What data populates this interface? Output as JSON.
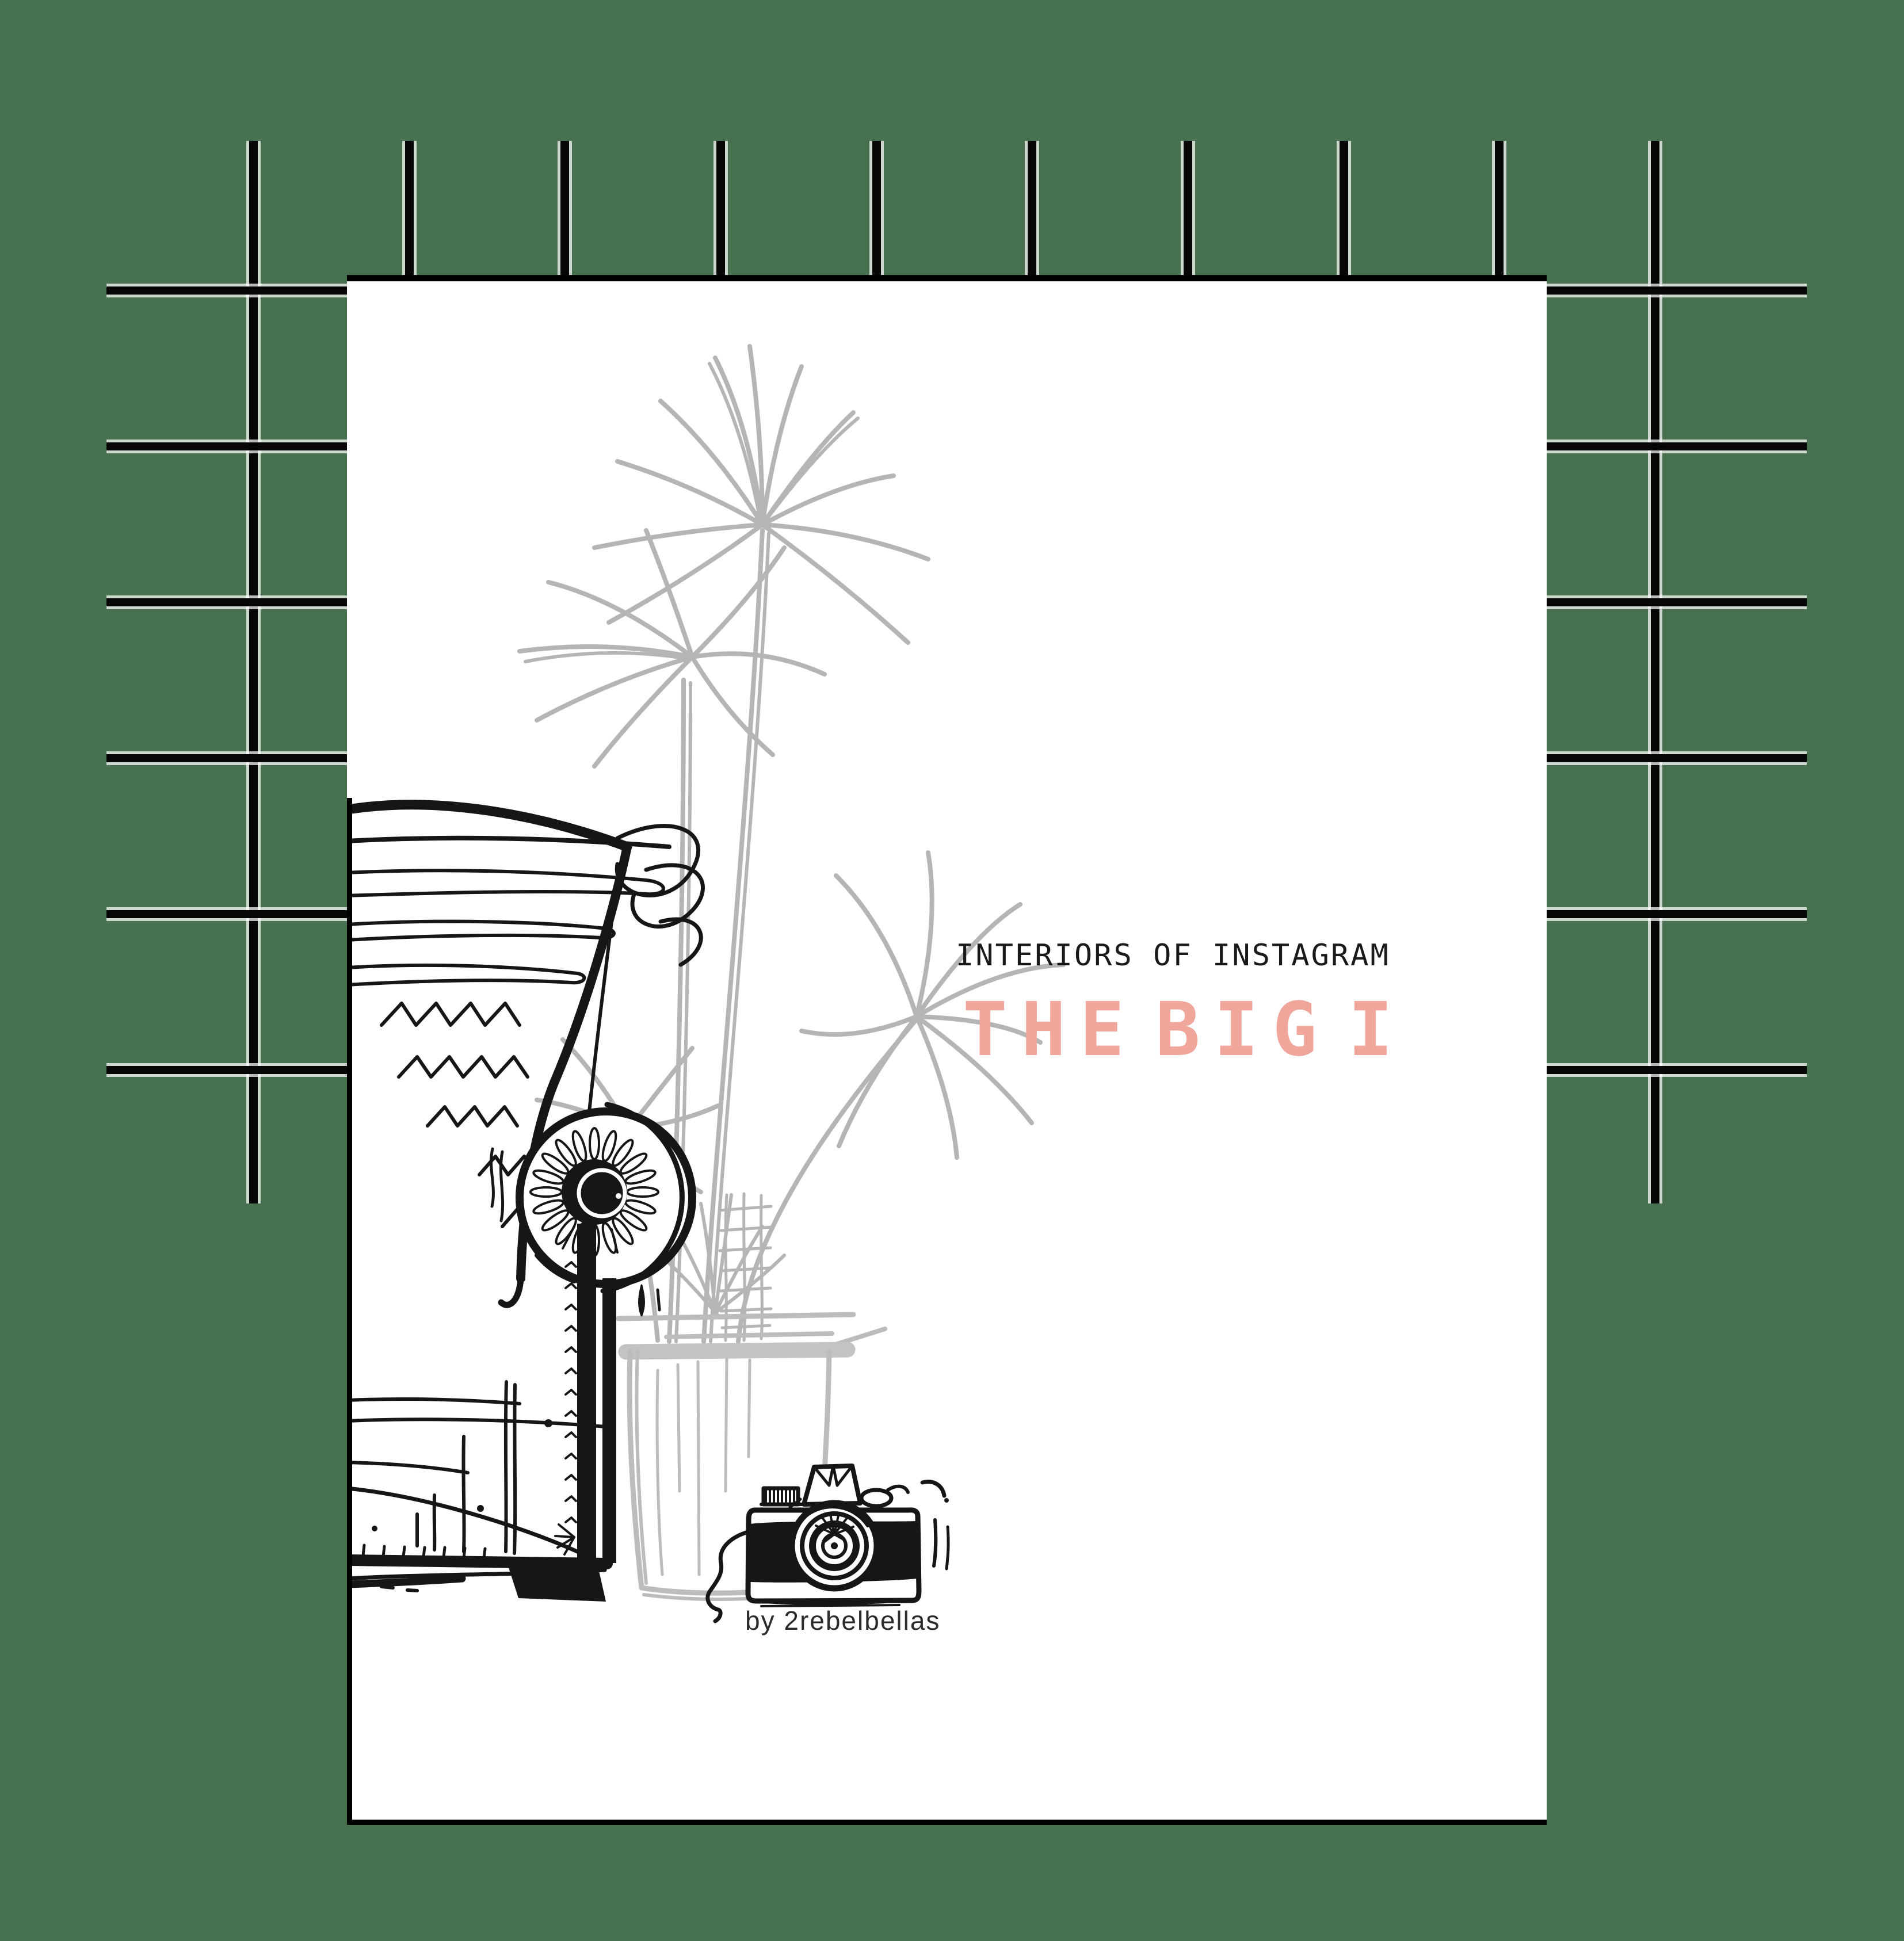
{
  "page": {
    "kicker": "INTERIORS OF INSTAGRAM",
    "title": {
      "word1": "THE",
      "word2": "BIG",
      "word3": "I",
      "full": "THE BIG I"
    },
    "byline": "by 2rebelbellas"
  },
  "illustration": {
    "items": [
      "armchair-sketch",
      "palm-plant-sketch",
      "plant-pot-sketch",
      "vintage-camera-sketch",
      "window-grid"
    ]
  },
  "colors": {
    "background": "#487150",
    "grid_line": "#060606",
    "grid_casing": "#ffffff",
    "page": "#ffffff",
    "ink": "#161616",
    "sketch_grey": "#b5b5b5",
    "title_pink": "#f0a69b",
    "kicker_black": "#1a1a1a",
    "byline_black": "#2b2b2b"
  }
}
